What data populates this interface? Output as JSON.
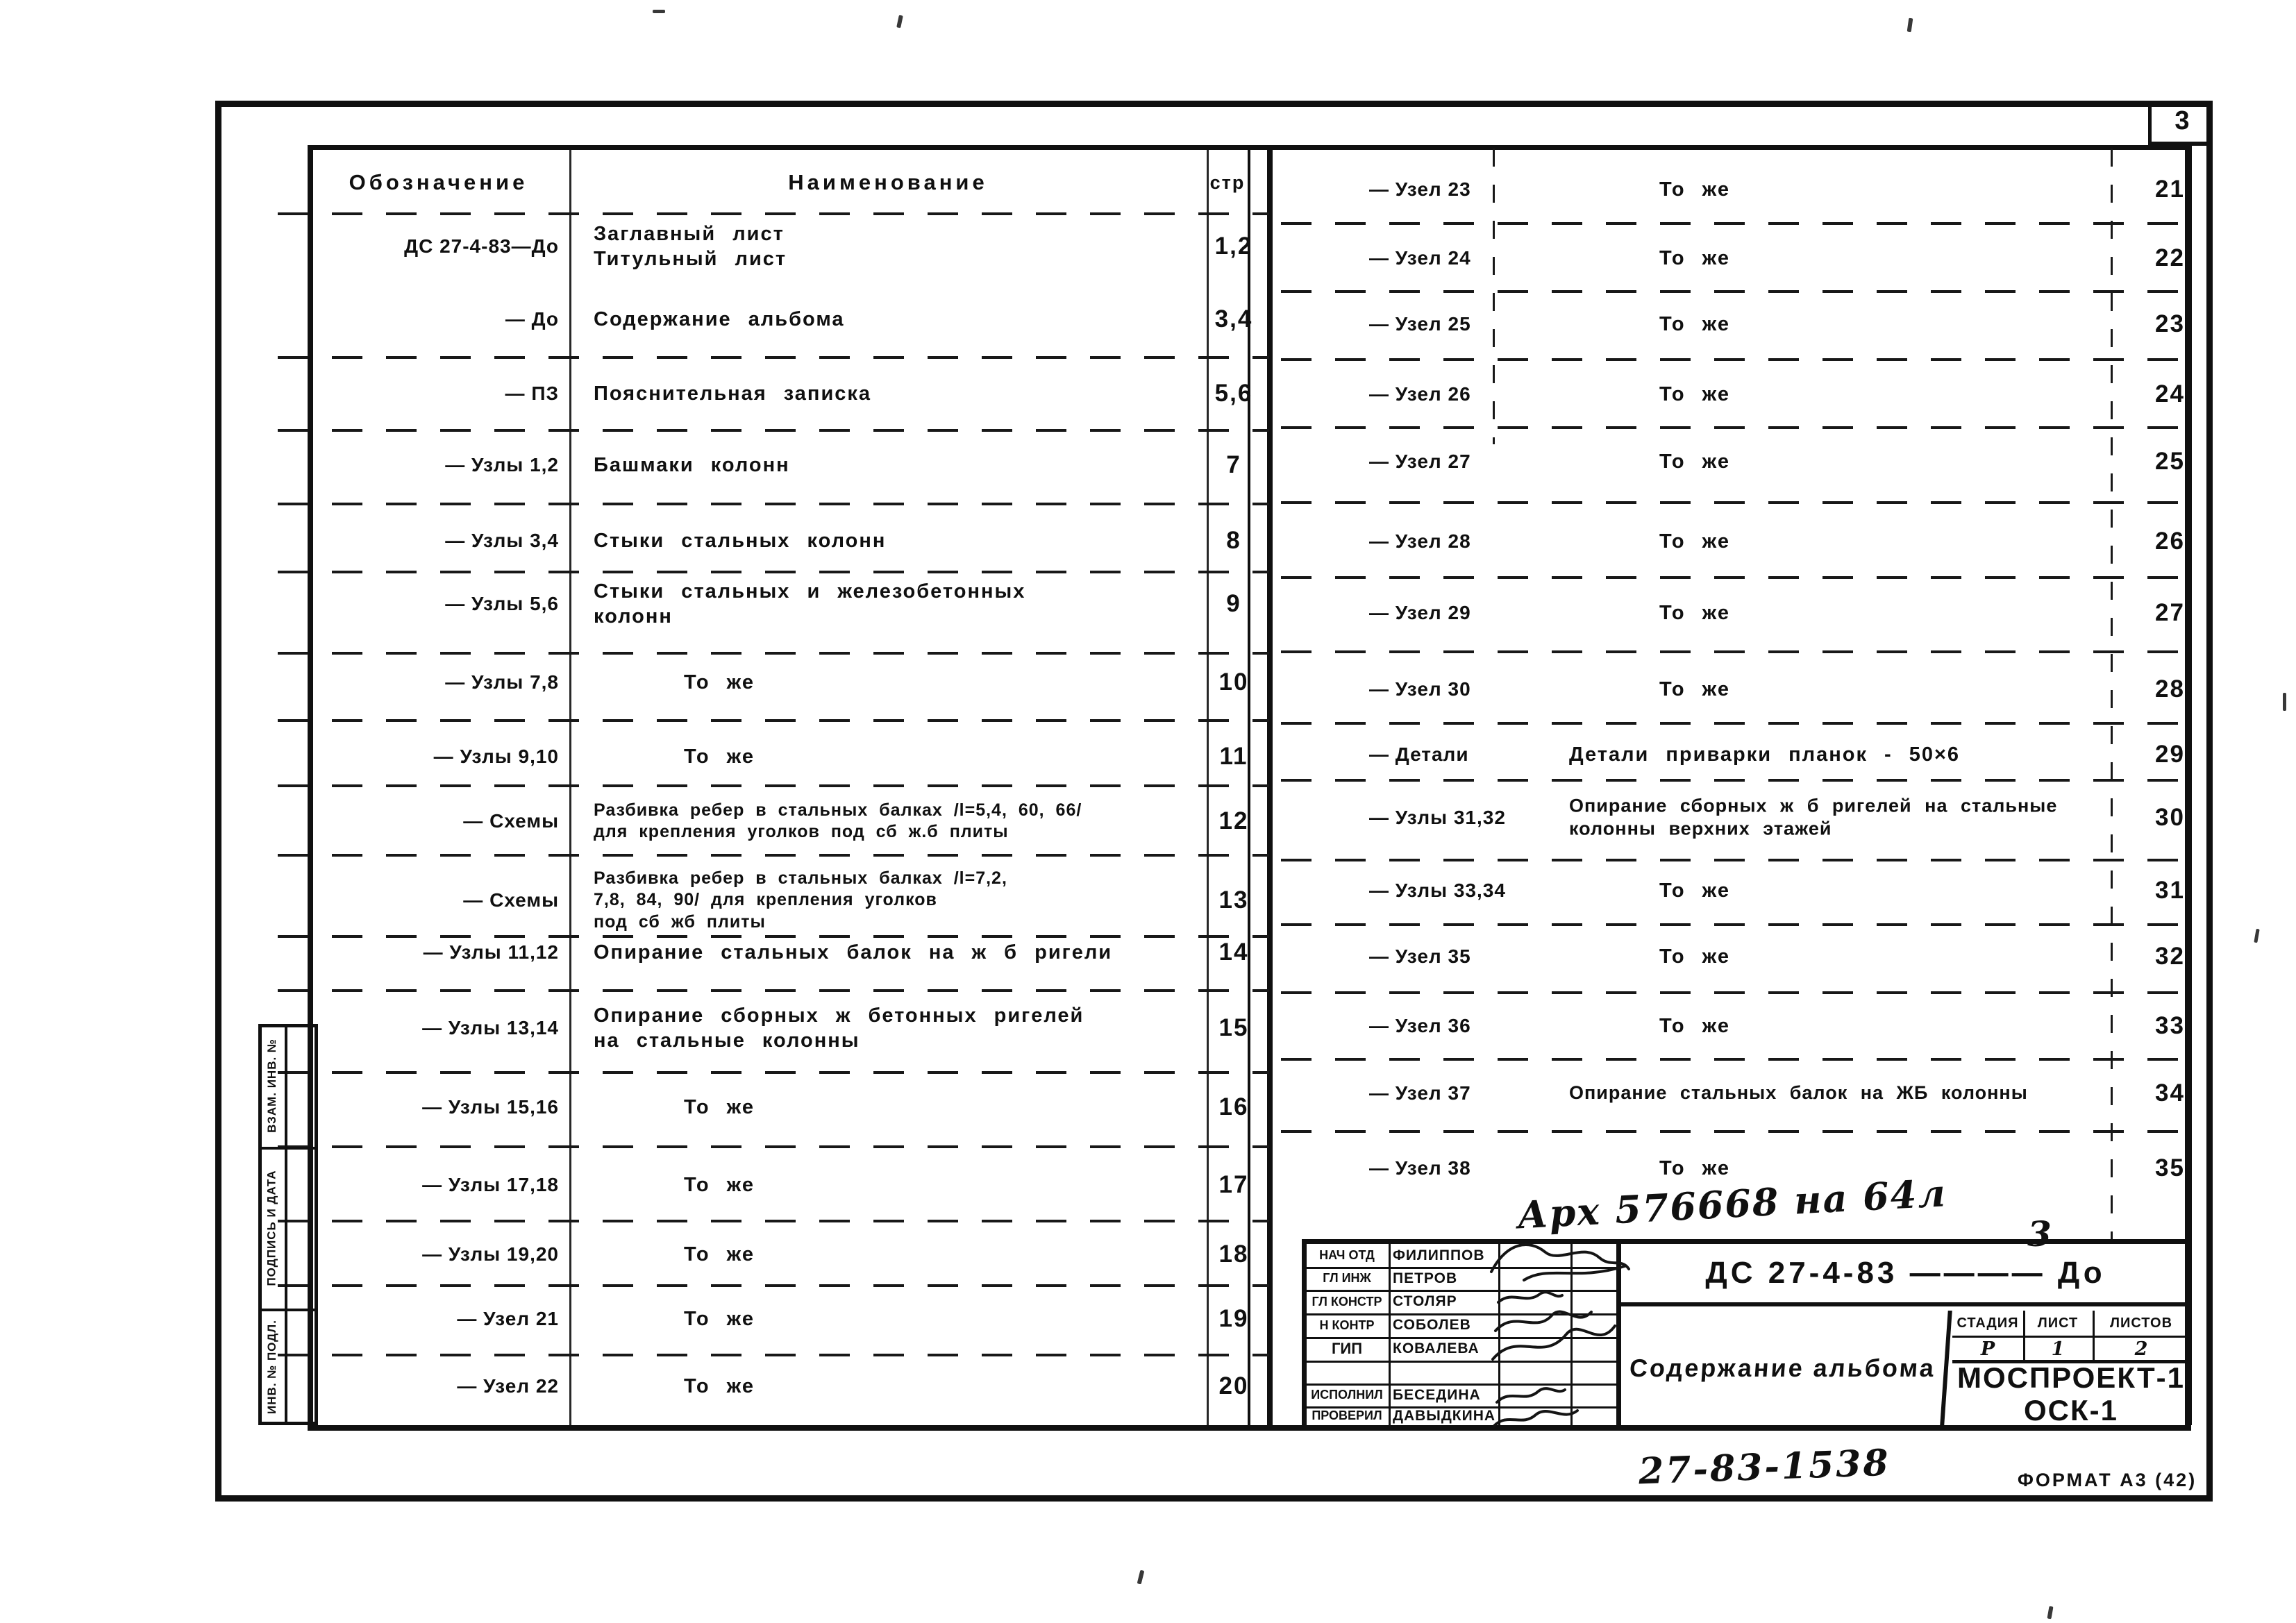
{
  "corner": {
    "page_number": "3"
  },
  "contents_table": {
    "headers": {
      "designation": "Обозначение",
      "name": "Наименование",
      "page": "стр"
    },
    "left_rows": [
      {
        "d": "ДС 27-4-83—До",
        "n": "Заглавный лист\nТитульный лист",
        "p": "1,2"
      },
      {
        "d": "— До",
        "n": "Содержание альбома",
        "p": "3,4"
      },
      {
        "d": "— ПЗ",
        "n": "Пояснительная записка",
        "p": "5,6"
      },
      {
        "d": "— Узлы 1,2",
        "n": "Башмаки колонн",
        "p": "7"
      },
      {
        "d": "— Узлы 3,4",
        "n": "Стыки стальных колонн",
        "p": "8"
      },
      {
        "d": "— Узлы 5,6",
        "n": "Стыки стальных и железобетонных\nколонн",
        "p": "9"
      },
      {
        "d": "— Узлы 7,8",
        "n": "То же",
        "p": "10"
      },
      {
        "d": "— Узлы 9,10",
        "n": "То же",
        "p": "11"
      },
      {
        "d": "— Схемы",
        "n": "Разбивка ребер в стальных балках /l=5,4, 60, 66/\nдля крепления уголков под сб ж.б плиты",
        "p": "12"
      },
      {
        "d": "— Схемы",
        "n": "Разбивка ребер в стальных балках /l=7,2,\n7,8, 84, 90/ для крепления уголков\nпод сб жб плиты",
        "p": "13"
      },
      {
        "d": "— Узлы 11,12",
        "n": "Опирание стальных балок на ж б ригели",
        "p": "14"
      },
      {
        "d": "— Узлы 13,14",
        "n": "Опирание сборных ж бетонных ригелей\nна стальные колонны",
        "p": "15"
      },
      {
        "d": "— Узлы 15,16",
        "n": "То же",
        "p": "16"
      },
      {
        "d": "— Узлы 17,18",
        "n": "То же",
        "p": "17"
      },
      {
        "d": "— Узлы 19,20",
        "n": "То же",
        "p": "18"
      },
      {
        "d": "— Узел 21",
        "n": "То же",
        "p": "19"
      },
      {
        "d": "— Узел 22",
        "n": "То же",
        "p": "20"
      }
    ],
    "right_rows": [
      {
        "d": "— Узел 23",
        "n": "То же",
        "p": "21"
      },
      {
        "d": "— Узел 24",
        "n": "То же",
        "p": "22"
      },
      {
        "d": "— Узел 25",
        "n": "То же",
        "p": "23"
      },
      {
        "d": "— Узел 26",
        "n": "То же",
        "p": "24"
      },
      {
        "d": "— Узел 27",
        "n": "То же",
        "p": "25"
      },
      {
        "d": "— Узел 28",
        "n": "То же",
        "p": "26"
      },
      {
        "d": "— Узел 29",
        "n": "То же",
        "p": "27"
      },
      {
        "d": "— Узел 30",
        "n": "То же",
        "p": "28"
      },
      {
        "d": "— Детали",
        "n": "Детали приварки планок - 50×6",
        "p": "29"
      },
      {
        "d": "— Узлы 31,32",
        "n": "Опирание сборных ж б ригелей на стальные\nколонны верхних этажей",
        "p": "30"
      },
      {
        "d": "— Узлы 33,34",
        "n": "То же",
        "p": "31"
      },
      {
        "d": "— Узел 35",
        "n": "То же",
        "p": "32"
      },
      {
        "d": "— Узел 36",
        "n": "То же",
        "p": "33"
      },
      {
        "d": "— Узел 37",
        "n": "Опирание стальных балок на ЖБ колонны",
        "p": "34"
      },
      {
        "d": "— Узел 38",
        "n": "То же",
        "p": "35"
      }
    ]
  },
  "side_strip": {
    "labels": [
      "ВЗАМ. ИНВ. №",
      "ПОДПИСЬ И ДАТА",
      "ИНВ. № ПОДЛ."
    ]
  },
  "stamp": {
    "rows": [
      {
        "role": "НАЧ ОТД",
        "name": "ФИЛИППОВ"
      },
      {
        "role": "ГЛ ИНЖ",
        "name": "ПЕТРОВ"
      },
      {
        "role": "ГЛ КОНСТР",
        "name": "СТОЛЯР"
      },
      {
        "role": "Н КОНТР",
        "name": "СОБОЛЕВ"
      },
      {
        "role": "ГИП",
        "name": "КОВАЛЕВА"
      },
      {
        "role": "",
        "name": ""
      },
      {
        "role": "ИСПОЛНИЛ",
        "name": "БЕСЕДИНА"
      },
      {
        "role": "ПРОВЕРИЛ",
        "name": "ДАВЫДКИНА"
      }
    ],
    "designation": "ДС 27-4-83 ———— До",
    "title": "Содержание альбома",
    "stage": {
      "label": "СТАДИЯ",
      "value": "Р"
    },
    "sheet": {
      "label": "ЛИСТ",
      "value": "1"
    },
    "sheets": {
      "label": "ЛИСТОВ",
      "value": "2"
    },
    "org_line1": "МОСПРОЕКТ-1",
    "org_line2": "ОСК-1"
  },
  "annotations": {
    "archive_note": "Арх 576668 на 64л",
    "archive_note_extra": "3",
    "doc_number": "27-83-1538",
    "format_label": "ФОРМАТ А3 (42)"
  }
}
